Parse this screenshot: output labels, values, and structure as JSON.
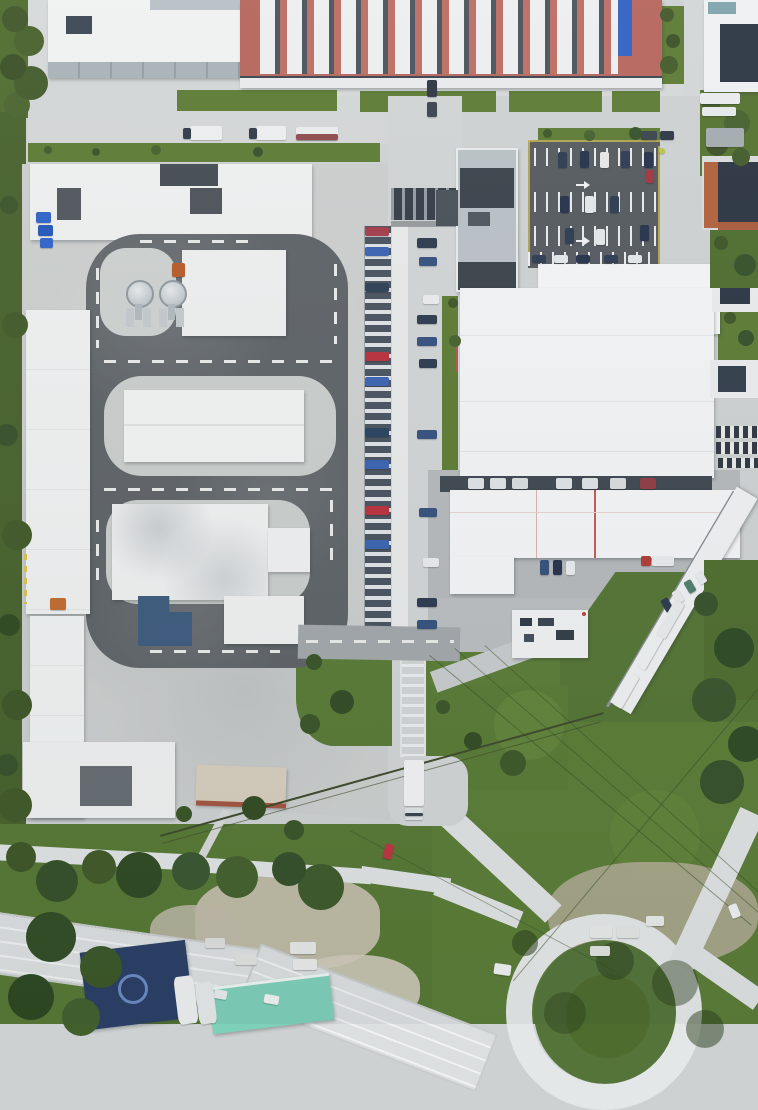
{
  "scene": {
    "type": "aerial-drone-photo",
    "description": "Top-down aerial drone view of an industrial business park: a factory hall with red roof and rows of white barrel skylights at top, a driver-training complex with a dark asphalt loop track, white halls and two silver tanks on the left, a central access road lined with columns of parked cars, large white warehouse roofs with a truck loading yard on the right, green lawns and tree belts, a curved multi-lane highway in the bottom-left and a roundabout with green center island in the bottom-right.",
    "palette": {
      "concrete": "#cdd1d1",
      "asphalt_track": "#5d6266",
      "asphalt_lot": "#54595e",
      "roof_white": "#f1f3f3",
      "roof_red": "#b5655c",
      "roof_navy": "#2a3442",
      "skylight_blue": "#3160c2",
      "blue_building": "#3d5a7d",
      "teal_roof": "#7ed0b9",
      "navy_structure": "#2b3f66",
      "grass": "#5c7a33",
      "field_green": "#5a7c36",
      "tree_dark": "#3c5226",
      "highway": "#dcdfe1",
      "yellow_marking": "#c9b54c",
      "orange_building": "#b0613c"
    },
    "landmarks": [
      "red-skylight-factory",
      "top-left-hall",
      "test-track-loop",
      "silver-tanks",
      "blue-l-building",
      "parked-car-column",
      "covered-bridge",
      "center-office-building",
      "striped-parking-lot",
      "warehouse-r1",
      "warehouse-r2",
      "warehouse-r3",
      "loading-dock",
      "diagonal-trailer-row",
      "footbridge-ladder",
      "box-truck",
      "cream-building",
      "teal-building",
      "navy-structure",
      "highway",
      "roundabout",
      "power-lines",
      "green-field"
    ]
  },
  "layers": {
    "sprites": [
      {
        "n": "truck",
        "x": 190,
        "y": 126,
        "w": 32,
        "h": 14,
        "c": "#eceef0"
      },
      {
        "n": "truck-cab",
        "x": 183,
        "y": 128,
        "w": 8,
        "h": 11,
        "c": "#2f3a48"
      },
      {
        "n": "truck",
        "x": 256,
        "y": 126,
        "w": 30,
        "h": 14,
        "c": "#eceef0"
      },
      {
        "n": "truck-cab",
        "x": 249,
        "y": 128,
        "w": 8,
        "h": 11,
        "c": "#2f3a48"
      },
      {
        "n": "truck",
        "x": 296,
        "y": 127,
        "w": 42,
        "h": 13,
        "c": "#e9ebec"
      },
      {
        "n": "truck-stripe",
        "x": 296,
        "y": 134,
        "w": 42,
        "h": 6,
        "c": "#8e4a4a"
      },
      {
        "n": "truck",
        "x": 700,
        "y": 93,
        "w": 40,
        "h": 11,
        "c": "#e9ebed"
      },
      {
        "n": "truck",
        "x": 702,
        "y": 107,
        "w": 34,
        "h": 9,
        "c": "#e6e9ea"
      },
      {
        "n": "van",
        "x": 706,
        "y": 128,
        "w": 38,
        "h": 19,
        "c": "#a4abb0"
      },
      {
        "n": "car",
        "x": 641,
        "y": 131,
        "w": 16,
        "h": 9,
        "c": "#39424d"
      },
      {
        "n": "car",
        "x": 660,
        "y": 131,
        "w": 14,
        "h": 9,
        "c": "#2c3544"
      },
      {
        "n": "dot",
        "x": 659,
        "y": 148,
        "w": 6,
        "h": 6,
        "c": "#b9c63e",
        "rad": 50
      },
      {
        "n": "car",
        "x": 427,
        "y": 80,
        "w": 10,
        "h": 17,
        "c": "#2c3544"
      },
      {
        "n": "car",
        "x": 427,
        "y": 102,
        "w": 10,
        "h": 15,
        "c": "#39424d"
      },
      {
        "n": "parked-car",
        "x": 365,
        "y": 227,
        "w": 24,
        "h": 9,
        "c": "#a33a4a"
      },
      {
        "n": "parked-car",
        "x": 365,
        "y": 247,
        "w": 24,
        "h": 9,
        "c": "#3a62b0"
      },
      {
        "n": "parked-car",
        "x": 365,
        "y": 283,
        "w": 24,
        "h": 9,
        "c": "#2d3f55"
      },
      {
        "n": "parked-car",
        "x": 365,
        "y": 352,
        "w": 24,
        "h": 9,
        "c": "#b8303c"
      },
      {
        "n": "parked-car",
        "x": 365,
        "y": 377,
        "w": 24,
        "h": 9,
        "c": "#3a62b0"
      },
      {
        "n": "parked-car",
        "x": 365,
        "y": 428,
        "w": 24,
        "h": 9,
        "c": "#27425f"
      },
      {
        "n": "parked-car",
        "x": 365,
        "y": 460,
        "w": 24,
        "h": 9,
        "c": "#3a62b0"
      },
      {
        "n": "parked-car",
        "x": 365,
        "y": 506,
        "w": 24,
        "h": 9,
        "c": "#b8303c"
      },
      {
        "n": "parked-car",
        "x": 365,
        "y": 540,
        "w": 24,
        "h": 9,
        "c": "#3a62b0"
      },
      {
        "n": "parked-car",
        "x": 417,
        "y": 238,
        "w": 20,
        "h": 10,
        "c": "#2c3a4e"
      },
      {
        "n": "parked-car",
        "x": 419,
        "y": 257,
        "w": 18,
        "h": 9,
        "c": "#34507c"
      },
      {
        "n": "parked-car",
        "x": 423,
        "y": 295,
        "w": 16,
        "h": 9,
        "c": "#e8eaec"
      },
      {
        "n": "parked-car",
        "x": 417,
        "y": 315,
        "w": 20,
        "h": 9,
        "c": "#2c3a4e"
      },
      {
        "n": "parked-car",
        "x": 417,
        "y": 337,
        "w": 20,
        "h": 9,
        "c": "#34507c"
      },
      {
        "n": "parked-car",
        "x": 419,
        "y": 359,
        "w": 18,
        "h": 9,
        "c": "#2c3a4e"
      },
      {
        "n": "parked-car",
        "x": 417,
        "y": 430,
        "w": 20,
        "h": 9,
        "c": "#34507c"
      },
      {
        "n": "parked-car",
        "x": 419,
        "y": 508,
        "w": 18,
        "h": 9,
        "c": "#34507c"
      },
      {
        "n": "parked-car",
        "x": 423,
        "y": 558,
        "w": 16,
        "h": 9,
        "c": "#e8eaec"
      },
      {
        "n": "parked-car",
        "x": 417,
        "y": 598,
        "w": 20,
        "h": 9,
        "c": "#2c3a4e"
      },
      {
        "n": "parked-car",
        "x": 417,
        "y": 620,
        "w": 20,
        "h": 9,
        "c": "#34507c"
      },
      {
        "n": "lot-car",
        "x": 558,
        "y": 152,
        "w": 9,
        "h": 16,
        "c": "#2c3a50"
      },
      {
        "n": "lot-car",
        "x": 580,
        "y": 151,
        "w": 9,
        "h": 17,
        "c": "#23314a"
      },
      {
        "n": "lot-car",
        "x": 600,
        "y": 152,
        "w": 9,
        "h": 16,
        "c": "#e4e7e9"
      },
      {
        "n": "lot-car",
        "x": 621,
        "y": 151,
        "w": 9,
        "h": 17,
        "c": "#2c3a50"
      },
      {
        "n": "lot-car",
        "x": 644,
        "y": 152,
        "w": 9,
        "h": 16,
        "c": "#23314a"
      },
      {
        "n": "lot-car",
        "x": 646,
        "y": 170,
        "w": 8,
        "h": 13,
        "c": "#a03540"
      },
      {
        "n": "lot-car",
        "x": 560,
        "y": 196,
        "w": 9,
        "h": 17,
        "c": "#23314a"
      },
      {
        "n": "lot-car",
        "x": 585,
        "y": 196,
        "w": 9,
        "h": 17,
        "c": "#e4e7e9"
      },
      {
        "n": "lot-car",
        "x": 610,
        "y": 196,
        "w": 9,
        "h": 17,
        "c": "#2c3a50"
      },
      {
        "n": "lot-car",
        "x": 640,
        "y": 225,
        "w": 9,
        "h": 16,
        "c": "#23314a"
      },
      {
        "n": "lot-car",
        "x": 565,
        "y": 228,
        "w": 9,
        "h": 16,
        "c": "#2c3a50"
      },
      {
        "n": "lot-car",
        "x": 596,
        "y": 229,
        "w": 9,
        "h": 16,
        "c": "#e4e7e9"
      },
      {
        "n": "lot-car",
        "x": 532,
        "y": 255,
        "w": 14,
        "h": 8,
        "c": "#2c3a50"
      },
      {
        "n": "lot-car",
        "x": 554,
        "y": 255,
        "w": 14,
        "h": 8,
        "c": "#e4e7e9"
      },
      {
        "n": "lot-car",
        "x": 576,
        "y": 255,
        "w": 14,
        "h": 8,
        "c": "#23314a"
      },
      {
        "n": "lot-car",
        "x": 604,
        "y": 255,
        "w": 14,
        "h": 8,
        "c": "#2c3a50"
      },
      {
        "n": "lot-car",
        "x": 628,
        "y": 255,
        "w": 14,
        "h": 8,
        "c": "#e4e7e9"
      },
      {
        "n": "dock-trailer",
        "x": 468,
        "y": 478,
        "w": 16,
        "h": 11,
        "c": "#dfe2e4"
      },
      {
        "n": "dock-trailer",
        "x": 490,
        "y": 478,
        "w": 16,
        "h": 11,
        "c": "#dfe2e4"
      },
      {
        "n": "dock-trailer",
        "x": 512,
        "y": 478,
        "w": 16,
        "h": 11,
        "c": "#d8dcde"
      },
      {
        "n": "dock-trailer",
        "x": 556,
        "y": 478,
        "w": 16,
        "h": 11,
        "c": "#dfe2e4"
      },
      {
        "n": "dock-trailer",
        "x": 582,
        "y": 478,
        "w": 16,
        "h": 11,
        "c": "#dfe2e4"
      },
      {
        "n": "dock-trailer",
        "x": 610,
        "y": 478,
        "w": 16,
        "h": 11,
        "c": "#d8dcde"
      },
      {
        "n": "dock-trailer",
        "x": 640,
        "y": 478,
        "w": 16,
        "h": 11,
        "c": "#8e3b42"
      },
      {
        "n": "yard-car",
        "x": 540,
        "y": 560,
        "w": 9,
        "h": 15,
        "c": "#34507c"
      },
      {
        "n": "yard-car",
        "x": 553,
        "y": 560,
        "w": 9,
        "h": 15,
        "c": "#23314a"
      },
      {
        "n": "yard-car",
        "x": 566,
        "y": 561,
        "w": 9,
        "h": 14,
        "c": "#e8eaec"
      },
      {
        "n": "truck-cab",
        "x": 641,
        "y": 556,
        "w": 10,
        "h": 10,
        "c": "#b03a35"
      },
      {
        "n": "truck-trailer",
        "x": 652,
        "y": 556,
        "w": 22,
        "h": 10,
        "c": "#e8eaec"
      },
      {
        "n": "yard-car",
        "x": 663,
        "y": 598,
        "w": 8,
        "h": 14,
        "c": "#2c3a4e",
        "r": -30
      },
      {
        "n": "yard-car",
        "x": 674,
        "y": 590,
        "w": 8,
        "h": 13,
        "c": "#e8eaec",
        "r": -30
      },
      {
        "n": "yard-car",
        "x": 686,
        "y": 580,
        "w": 8,
        "h": 13,
        "c": "#4f7d6d",
        "r": -30
      },
      {
        "n": "yard-car",
        "x": 697,
        "y": 571,
        "w": 8,
        "h": 13,
        "c": "#e8eaec",
        "r": -30
      },
      {
        "n": "trailer",
        "x": 630,
        "y": 645,
        "w": 40,
        "h": 11,
        "c": "#eef0f1",
        "r": -60
      },
      {
        "n": "trailer",
        "x": 650,
        "y": 614,
        "w": 40,
        "h": 11,
        "c": "#e8ebec",
        "r": -60
      },
      {
        "n": "trailer",
        "x": 608,
        "y": 686,
        "w": 36,
        "h": 10,
        "c": "#eef0f1",
        "r": -60
      },
      {
        "n": "box-truck-body",
        "x": 404,
        "y": 760,
        "w": 20,
        "h": 46,
        "c": "#f0f2f3"
      },
      {
        "n": "box-truck-cab",
        "x": 405,
        "y": 808,
        "w": 18,
        "h": 12,
        "c": "#dfe3e5"
      },
      {
        "n": "box-truck-windshield",
        "x": 405,
        "y": 813,
        "w": 18,
        "h": 3,
        "c": "#39424d"
      },
      {
        "n": "car",
        "x": 384,
        "y": 844,
        "w": 9,
        "h": 15,
        "c": "#bb3642",
        "r": 15
      },
      {
        "n": "van",
        "x": 494,
        "y": 964,
        "w": 17,
        "h": 11,
        "c": "#eef0f1",
        "r": 8
      },
      {
        "n": "van",
        "x": 264,
        "y": 995,
        "w": 15,
        "h": 9,
        "c": "#f0f2f2",
        "r": 10
      },
      {
        "n": "car",
        "x": 214,
        "y": 990,
        "w": 13,
        "h": 9,
        "c": "#e8ebec",
        "r": 10
      },
      {
        "n": "car",
        "x": 730,
        "y": 904,
        "w": 9,
        "h": 14,
        "c": "#eef0f1",
        "r": -22
      },
      {
        "n": "bin",
        "x": 36,
        "y": 212,
        "w": 15,
        "h": 11,
        "c": "#2f62c8"
      },
      {
        "n": "bin",
        "x": 38,
        "y": 225,
        "w": 15,
        "h": 11,
        "c": "#2456b8"
      },
      {
        "n": "bin",
        "x": 40,
        "y": 238,
        "w": 13,
        "h": 10,
        "c": "#2f62c8"
      },
      {
        "n": "machine",
        "x": 50,
        "y": 598,
        "w": 16,
        "h": 12,
        "c": "#c06a2e"
      },
      {
        "n": "machine",
        "x": 172,
        "y": 263,
        "w": 13,
        "h": 14,
        "c": "#b55a28"
      },
      {
        "n": "container",
        "x": 290,
        "y": 942,
        "w": 26,
        "h": 12,
        "c": "#e6e8e6"
      },
      {
        "n": "container",
        "x": 235,
        "y": 955,
        "w": 22,
        "h": 10,
        "c": "#dfe2df"
      },
      {
        "n": "container",
        "x": 293,
        "y": 959,
        "w": 24,
        "h": 11,
        "c": "#e9ebe9"
      },
      {
        "n": "container",
        "x": 205,
        "y": 938,
        "w": 20,
        "h": 10,
        "c": "#dcdfdc"
      },
      {
        "n": "container",
        "x": 590,
        "y": 926,
        "w": 22,
        "h": 12,
        "c": "#e8eae8"
      },
      {
        "n": "container",
        "x": 617,
        "y": 926,
        "w": 22,
        "h": 12,
        "c": "#e2e5e2"
      },
      {
        "n": "container",
        "x": 646,
        "y": 916,
        "w": 18,
        "h": 10,
        "c": "#e8eae8"
      },
      {
        "n": "container",
        "x": 590,
        "y": 946,
        "w": 20,
        "h": 10,
        "c": "#dfe2df"
      },
      {
        "n": "tank",
        "x": 176,
        "y": 976,
        "w": 20,
        "h": 48,
        "c": "#eef0f0",
        "r": -7,
        "rad": 18
      },
      {
        "n": "tank",
        "x": 197,
        "y": 982,
        "w": 18,
        "h": 42,
        "c": "#e6e9e9",
        "r": -7,
        "rad": 18
      }
    ]
  }
}
